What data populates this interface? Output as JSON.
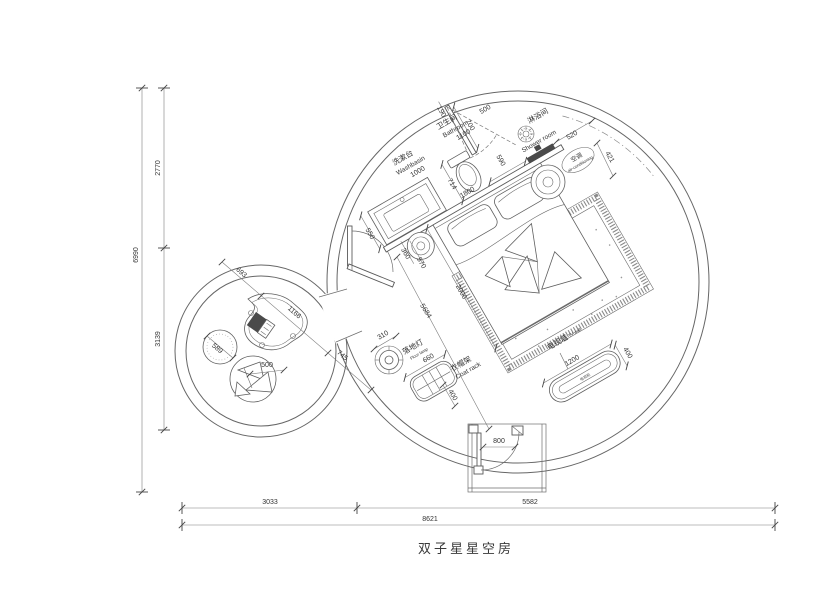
{
  "title": "双子星星空房",
  "labels": {
    "washbasin": {
      "zh": "洗漱台",
      "en": "Washbasin"
    },
    "bathroom": {
      "zh": "卫生间",
      "en": "Bathroom"
    },
    "shower": {
      "zh": "淋浴间",
      "en": "Shower room"
    },
    "ac": {
      "zh": "空调",
      "en": "air-conditioning"
    },
    "floor_lamp": {
      "zh": "落地灯",
      "en": "Floor lamp"
    },
    "coat_rack": {
      "zh": "衣帽架",
      "en": "Coat rack"
    },
    "tv_wall": {
      "zh": "电视墙",
      "en": "TV wall"
    },
    "tv_cabinet": {
      "zh": "电视柜"
    }
  },
  "dims": {
    "d190": "190",
    "d700": "700",
    "d500_shower": "500",
    "d590": "590",
    "d520": "520",
    "d421": "421",
    "d1000": "1000",
    "d550": "550",
    "d1100": "1100",
    "d714": "714",
    "d1800": "1800",
    "d360": "360",
    "d570": "570",
    "d2000": "2000",
    "d5684": "5684",
    "d310": "310",
    "d660": "660",
    "d400_coat": "400",
    "d1200": "1200",
    "d400_tv": "400",
    "d800": "800",
    "d693": "693",
    "d1166": "1166",
    "d745": "745",
    "d589": "589",
    "d500_chair": "500",
    "v2770": "2770",
    "v3139": "3139",
    "v6990": "6990",
    "h3033": "3033",
    "h5582": "5582",
    "h8621": "8621"
  }
}
